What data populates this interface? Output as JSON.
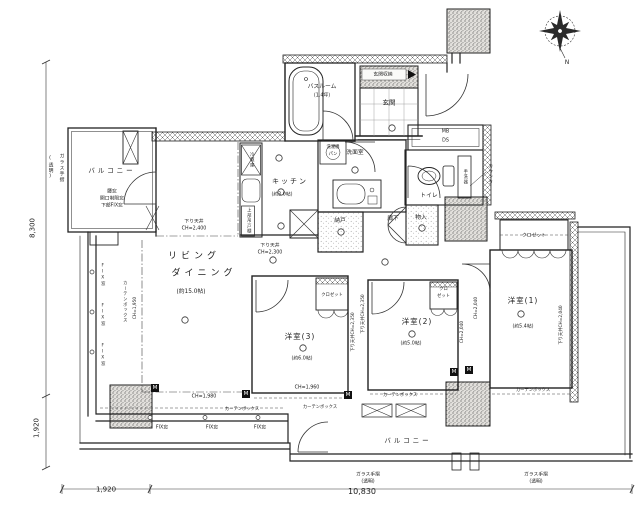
{
  "compass": {
    "north": "N"
  },
  "rooms": {
    "balcony_left": "バルコニー",
    "balcony_bottom": "バルコニー",
    "living1": "リビング",
    "living2": "ダイニング",
    "living_size": "(約15.0帖)",
    "kitchen": "キッチン",
    "kitchen_size": "(約3.0帖)",
    "bath": "バスルーム",
    "bath_size": "(1.4坪)",
    "washroom": "洗面室",
    "toilet": "トイレ",
    "entrance": "玄関",
    "entrance_storage": "玄関収納",
    "nando": "納戸",
    "hallway": "廊下",
    "monoire": "物入",
    "bedroom1": "洋室(1)",
    "bedroom1_size": "(約5.4帖)",
    "bedroom2": "洋室(2)",
    "bedroom2_size": "(約5.0帖)",
    "bedroom3": "洋室(3)",
    "bedroom3_size": "(約6.0帖)",
    "closet1": "クロゼット",
    "closet2_1": "クロ",
    "closet2_2": "ゼット",
    "closet3": "クロゼット"
  },
  "fixtures": {
    "washer1": "洗濯機",
    "washer2": "パン",
    "fridge": "冷蔵庫",
    "cabinet": "上部吊戸棚",
    "hand_basin": "手洗器",
    "counter": "カウンター",
    "mb": "MB",
    "ds": "DS",
    "m_mark": "M"
  },
  "annotations": {
    "window_note": [
      "腰窓",
      "開口制限窓",
      "下部FIX窓"
    ],
    "ceiling_2400_1": "下り天井",
    "ceiling_2400_2": "CH=2,400",
    "ceiling_2300_1": "下り天井",
    "ceiling_2300_2": "CH=2,300",
    "ch_1950": "CH=1,950",
    "ch_1980": "CH=1,980",
    "ch_1960": "CH=1,960",
    "ceiling_2350": "下り天井CH=2,350",
    "ch_2040": "CH=2,040",
    "ceiling_2040": "下り天井CH=2,040",
    "fix_window": "FIX窓",
    "curtain_box": "カーテンボックス",
    "glass_rail": "ガラス手摺",
    "glass_rail_note": "(透明)"
  },
  "dimensions": {
    "left_upper": "8,300",
    "left_lower": "1,920",
    "bottom_left": "1,920",
    "bottom_main": "10,830"
  }
}
